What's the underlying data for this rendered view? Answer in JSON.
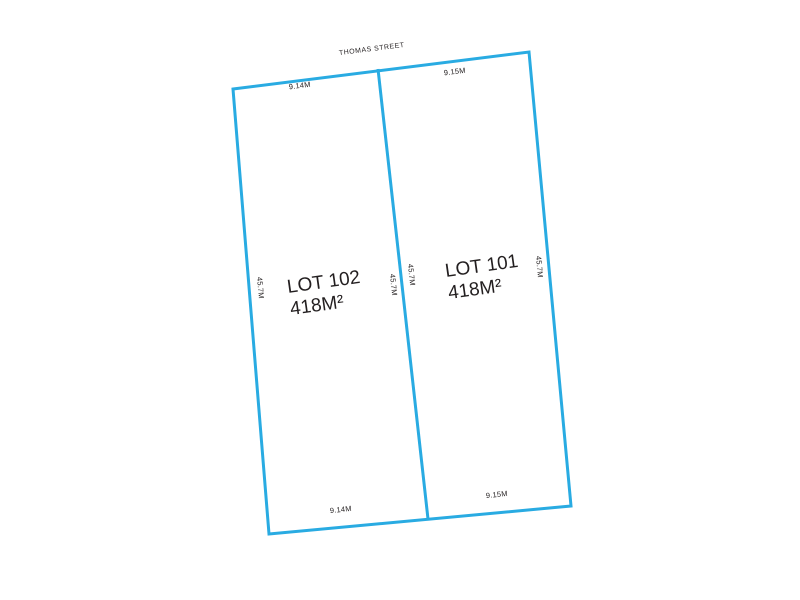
{
  "plan": {
    "street_name": "THOMAS STREET",
    "lots": [
      {
        "name": "LOT 102",
        "area": "418M²",
        "frontage_top": "9.14M",
        "frontage_bottom": "9.14M",
        "depth_left": "45.7M",
        "depth_right": "45.7M"
      },
      {
        "name": "LOT 101",
        "area": "418M²",
        "frontage_top": "9.15M",
        "frontage_bottom": "9.15M",
        "depth_left": "45.7M",
        "depth_right": "45.7M"
      }
    ]
  },
  "colors": {
    "boundary": "#29ABE2",
    "label": "#231F20",
    "background": "#FFFFFF"
  }
}
